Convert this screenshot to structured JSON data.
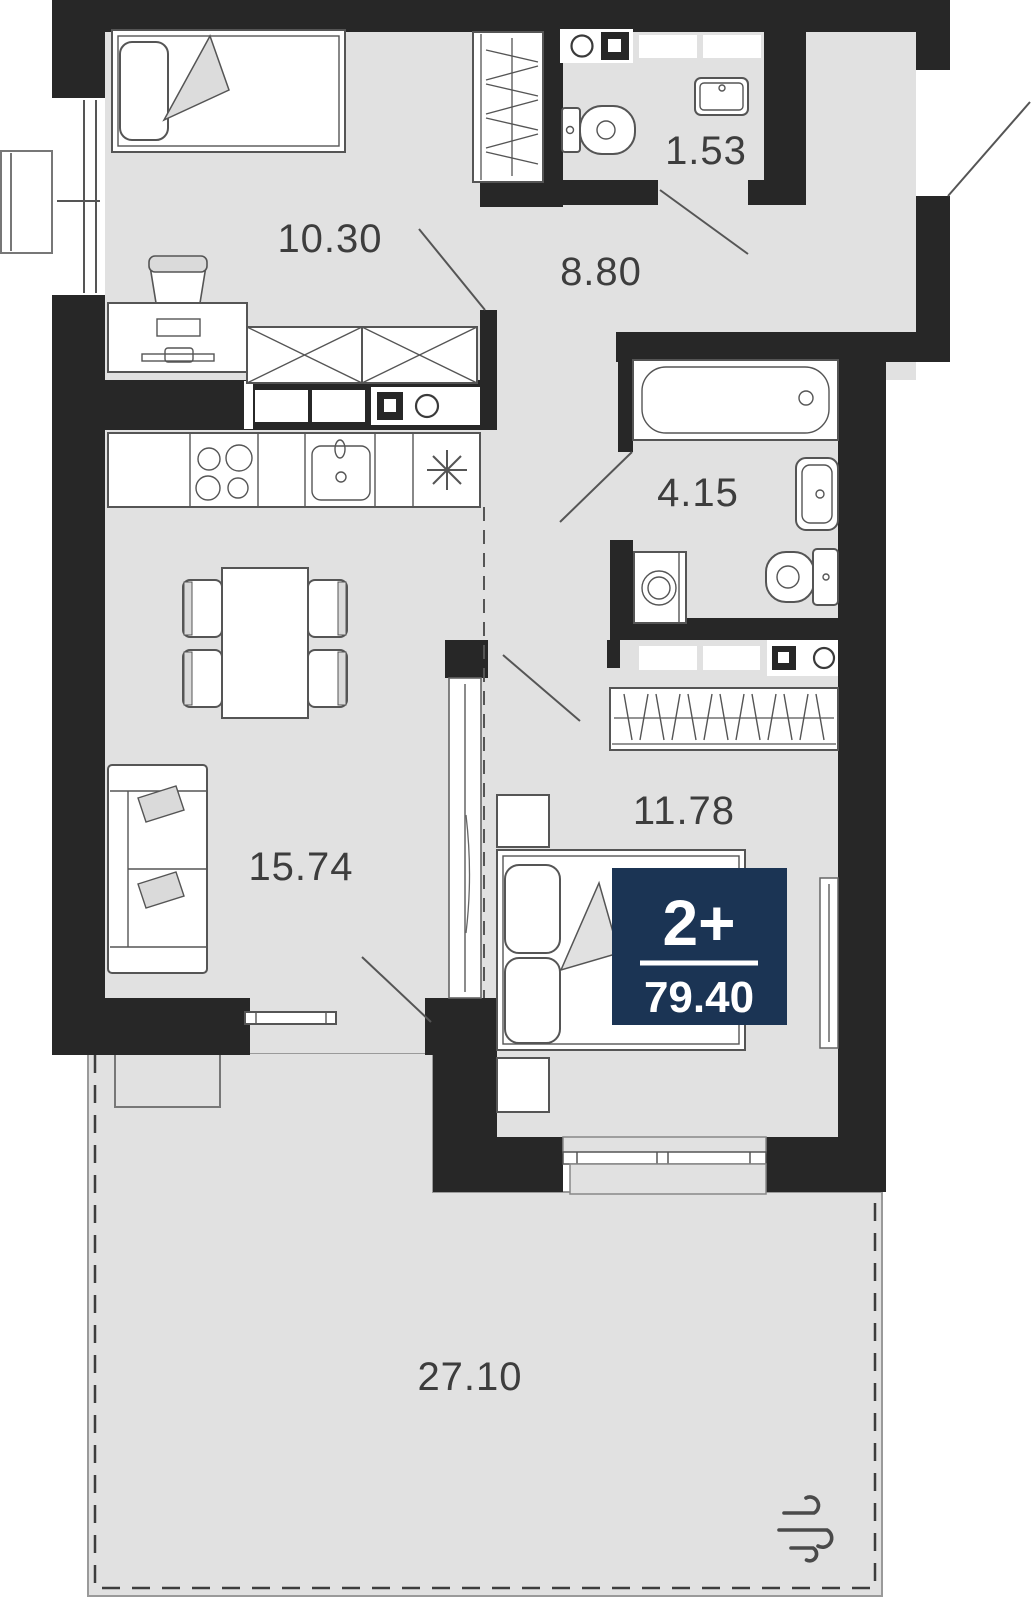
{
  "plan": {
    "badge": {
      "rooms_label": "2+",
      "total_area": "79.40",
      "bg_color": "#1b3454"
    },
    "rooms": [
      {
        "name": "bedroom-secondary",
        "area": "10.30"
      },
      {
        "name": "hallway",
        "area": "8.80"
      },
      {
        "name": "wc",
        "area": "1.53"
      },
      {
        "name": "bathroom",
        "area": "4.15"
      },
      {
        "name": "living-kitchen",
        "area": "15.74"
      },
      {
        "name": "bedroom-primary",
        "area": "11.78"
      },
      {
        "name": "terrace",
        "area": "27.10"
      }
    ],
    "icons": {
      "ventilation": "wind-icon"
    },
    "colors": {
      "wall": "#272727",
      "floor": "#e1e1e1",
      "badge": "#1b3454",
      "label": "#3d3d3d",
      "outline": "#555555"
    }
  }
}
